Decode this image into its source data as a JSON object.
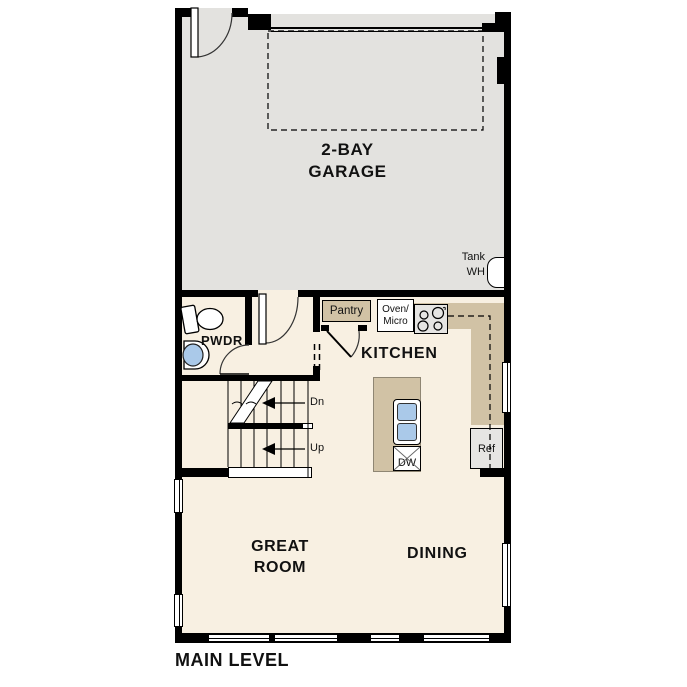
{
  "title": "MAIN LEVEL",
  "rooms": {
    "garage": {
      "line1": "2-BAY",
      "line2": "GARAGE"
    },
    "kitchen": "KITCHEN",
    "great_room": {
      "line1": "GREAT",
      "line2": "ROOM"
    },
    "dining": "DINING",
    "powder": "PWDR"
  },
  "stairs": {
    "down": "Dn",
    "up": "Up"
  },
  "fixtures": {
    "water_heater": {
      "line1": "Tank",
      "line2": "WH"
    },
    "pantry": "Pantry",
    "oven_micro": {
      "line1": "Oven/",
      "line2": "Micro"
    },
    "dishwasher": "DW",
    "refrigerator": "Ref"
  },
  "colors": {
    "wall": "#000000",
    "garage_floor": "#e3e2df",
    "interior_floor": "#f8f0e2",
    "counter": "#d1c2a5",
    "appliance": "#e6e5e3",
    "sink_fill": "#aac9e9",
    "background": "#ffffff"
  }
}
